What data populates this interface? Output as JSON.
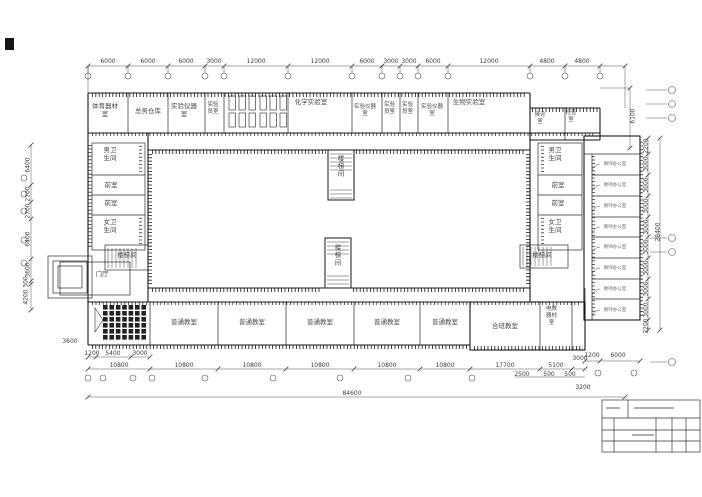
{
  "rooms": {
    "top": [
      "体育器材室",
      "总务仓库",
      "实验仪器室",
      "实验员室",
      "化学实验室",
      "实验仪器室",
      "实验员室",
      "实验员室",
      "实验仪器室",
      "生物实验室",
      "候诊室",
      "检查室"
    ],
    "left": [
      "男卫生间",
      "前室",
      "前室",
      "女卫生间",
      "楼梯间",
      "门厅"
    ],
    "right": [
      "男卫生间",
      "前室",
      "前室",
      "女卫生间",
      "楼梯间"
    ],
    "stair": "楼梯间",
    "office": "教师办公室",
    "bottom": [
      "普通教室",
      "合班教室",
      "电教器材室"
    ]
  },
  "dims": {
    "top": [
      "6000",
      "6000",
      "6000",
      "3000",
      "12000",
      "12000",
      "6000",
      "3000",
      "3000",
      "6000",
      "12000",
      "4800",
      "4800"
    ],
    "left": [
      "6400",
      "2700",
      "2700",
      "6400",
      "3600",
      "300",
      "4200"
    ],
    "left_bottom": "3600",
    "right_upper": "6100",
    "right_end": "2200",
    "right_room": "3000",
    "right_total": "28400",
    "bottom_row1": [
      "1200",
      "5400",
      "3000"
    ],
    "bottom_bay": "10800",
    "bottom_rest": [
      "17700",
      "5100",
      "3000"
    ],
    "bottom_right": [
      "1200",
      "6000"
    ],
    "bottom_sub": [
      "2500",
      "500",
      "500",
      "3200"
    ],
    "total_width": "84600"
  }
}
